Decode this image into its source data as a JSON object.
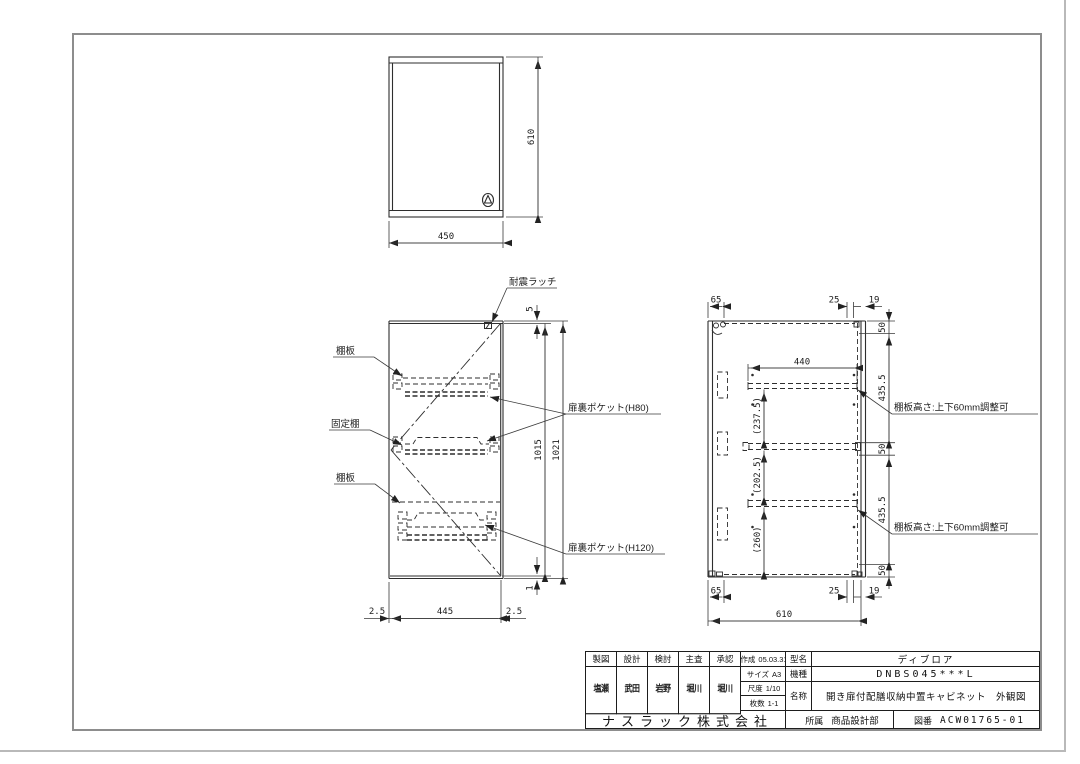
{
  "title_block": {
    "approval_headers": [
      "製図",
      "設計",
      "検討",
      "主査",
      "承認"
    ],
    "approval_names": [
      "塩瀬",
      "武田",
      "岩野",
      "堀川",
      "堀川"
    ],
    "created_label": "作成",
    "created_value": "05.03.31",
    "size_label": "サイズ",
    "size_value": "A3",
    "scale_label": "尺度",
    "scale_value": "1/10",
    "sheets_label": "枚数",
    "sheets_value": "1-1",
    "company": "ナスラック株式会社",
    "model_label": "型名",
    "model_value": "ディブロア",
    "series_label": "機種",
    "series_value": "DNBS045***L",
    "name_label": "名称",
    "name_value": "開き扉付配膳収納中置キャビネット　外観図",
    "dept_label": "所属",
    "dept_value": "商品設計部",
    "dwgno_label": "図番",
    "dwgno_value": "ACW01765-01"
  },
  "drawing": {
    "top_view": {
      "dim_width": "450",
      "dim_depth": "610"
    },
    "front_view": {
      "label_latch": "耐震ラッチ",
      "label_shelf": "棚板",
      "label_fixed_shelf": "固定棚",
      "label_pocket_h80": "扉裏ポケット(H80)",
      "label_pocket_h120": "扉裏ポケット(H120)",
      "dim_top_gap": "5",
      "dim_door_height": "1015",
      "dim_total_height": "1021",
      "dim_bottom_gap": "1",
      "dim_side_gap": "2.5",
      "dim_door_width": "445"
    },
    "side_view": {
      "note_shelf_adjust": "棚板高さ:上下60mm調整可",
      "dim_back_offset": "65",
      "dim_front_offset": "25",
      "dim_door_thickness": "19",
      "dim_50": "50",
      "dim_435": "435.5",
      "dim_shelf_depth": "440",
      "dim_space_top": "(237.5)",
      "dim_space_mid": "(202.5)",
      "dim_space_bottom": "(260)",
      "dim_total_depth": "610"
    }
  }
}
